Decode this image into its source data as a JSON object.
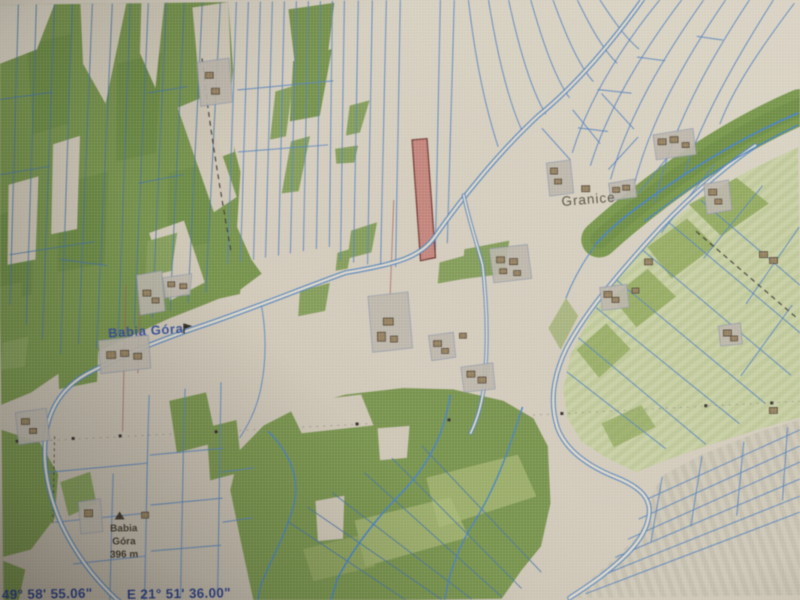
{
  "map": {
    "labels": {
      "village": "Babia Góra",
      "hamlet": "Granice",
      "peak_line1": "Babia",
      "peak_line2": "Góra",
      "peak_elevation": "396 m"
    },
    "coordinates": {
      "latitude": "49° 58' 55.06\"",
      "longitude": "E 21° 51' 36.00\""
    },
    "selected_parcel": {
      "fill": "#c47c74",
      "stroke": "#6e352e"
    },
    "icons": {
      "peak_marker": "triangle-icon",
      "village_marker": "flag-icon"
    },
    "colors": {
      "paper_beige": "#d2c9b8",
      "forest_green": "#6d8c41",
      "field_green": "#c6cf9e",
      "parcel_line_blue": "#4d7dbd",
      "stream_blue": "#3e7bc8",
      "road_fill": "#ddd7c8",
      "building_brown": "#8f7a58",
      "label_blue": "#2f4b9e",
      "label_dark": "#4e4a3a",
      "coordinate_blue": "#243a8a"
    }
  }
}
